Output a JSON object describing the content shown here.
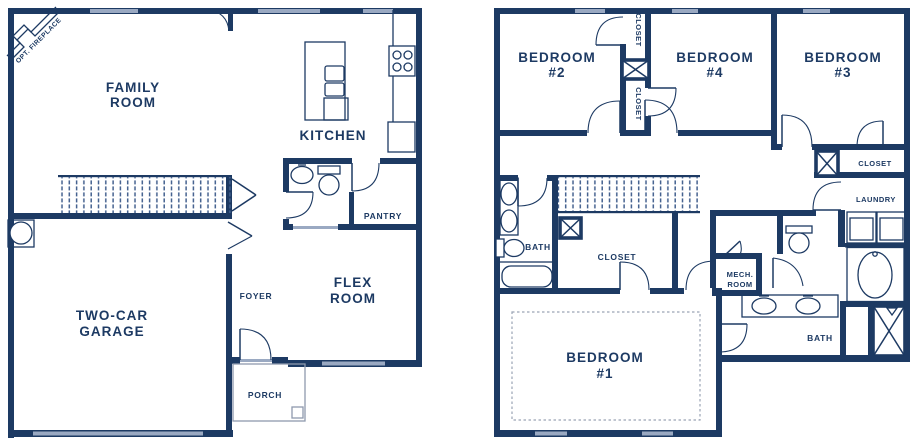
{
  "colors": {
    "bg": "#ffffff",
    "wall": "#1d3a63",
    "window": "#9aa9c2",
    "ink": "#1d3a63",
    "porch": "#8e99ad",
    "dash": "#9aa3b5",
    "stair": "#44618f"
  },
  "first_floor": {
    "labels": {
      "opt_fireplace": "OPT. FIREPLACE",
      "family_room": [
        "FAMILY",
        "ROOM"
      ],
      "kitchen": "KITCHEN",
      "pantry": "PANTRY",
      "foyer": "FOYER",
      "flex_room": [
        "FLEX",
        "ROOM"
      ],
      "garage": [
        "TWO-CAR",
        "GARAGE"
      ],
      "porch": "PORCH"
    }
  },
  "second_floor": {
    "labels": {
      "bedroom_2": [
        "BEDROOM",
        "#2"
      ],
      "bedroom_4": [
        "BEDROOM",
        "#4"
      ],
      "bedroom_3": [
        "BEDROOM",
        "#3"
      ],
      "closet_top": "CLOSET",
      "closet_mid": "CLOSET",
      "closet_b3": "CLOSET",
      "laundry": "LAUNDRY",
      "bath_hall": "BATH",
      "closet_owner": "CLOSET",
      "mech_room": [
        "MECH.",
        "ROOM"
      ],
      "bath_owner": "BATH",
      "bedroom_1": [
        "BEDROOM",
        "#1"
      ]
    }
  }
}
